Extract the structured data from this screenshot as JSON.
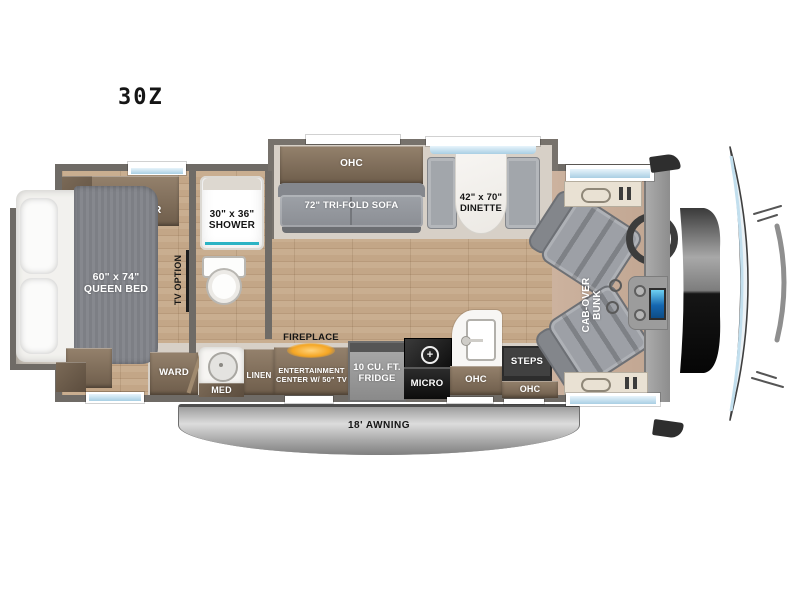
{
  "title": "30Z",
  "floorplan": {
    "bedroom": {
      "dresser": "DRESSER",
      "queen_bed": "60\" x 74\"\nQUEEN BED",
      "ward": "WARD",
      "tv_option": "TV OPTION"
    },
    "bathroom": {
      "shower": "30\" x 36\"\nSHOWER",
      "med": "MED",
      "linen": "LINEN"
    },
    "living": {
      "ohc": "OHC",
      "sofa": "72\" TRI-FOLD SOFA",
      "dinette": "42\" x 70\"\nDINETTE",
      "fireplace": "FIREPLACE",
      "entertainment": "ENTERTAINMENT\nCENTER W/ 50\" TV"
    },
    "kitchen": {
      "fridge": "10 CU. FT.\nFRIDGE",
      "micro": "MICRO",
      "ohc": "OHC"
    },
    "entry": {
      "steps": "STEPS",
      "ohc": "OHC"
    },
    "cab": {
      "bunk": "CAB-OVER\nBUNK"
    },
    "exterior": {
      "awning": "18' AWNING"
    },
    "colors": {
      "wall": "#6f6b66",
      "wood_cabinet": "#84715d",
      "floor_wood": "#c8ac8d",
      "window_glass": "#cde9f6",
      "shower_accent": "#2bb3c4",
      "fireplace_glow": "#f5a623",
      "seat_gray": "#8f9296",
      "awning_silver": "#b5b5b5"
    }
  }
}
